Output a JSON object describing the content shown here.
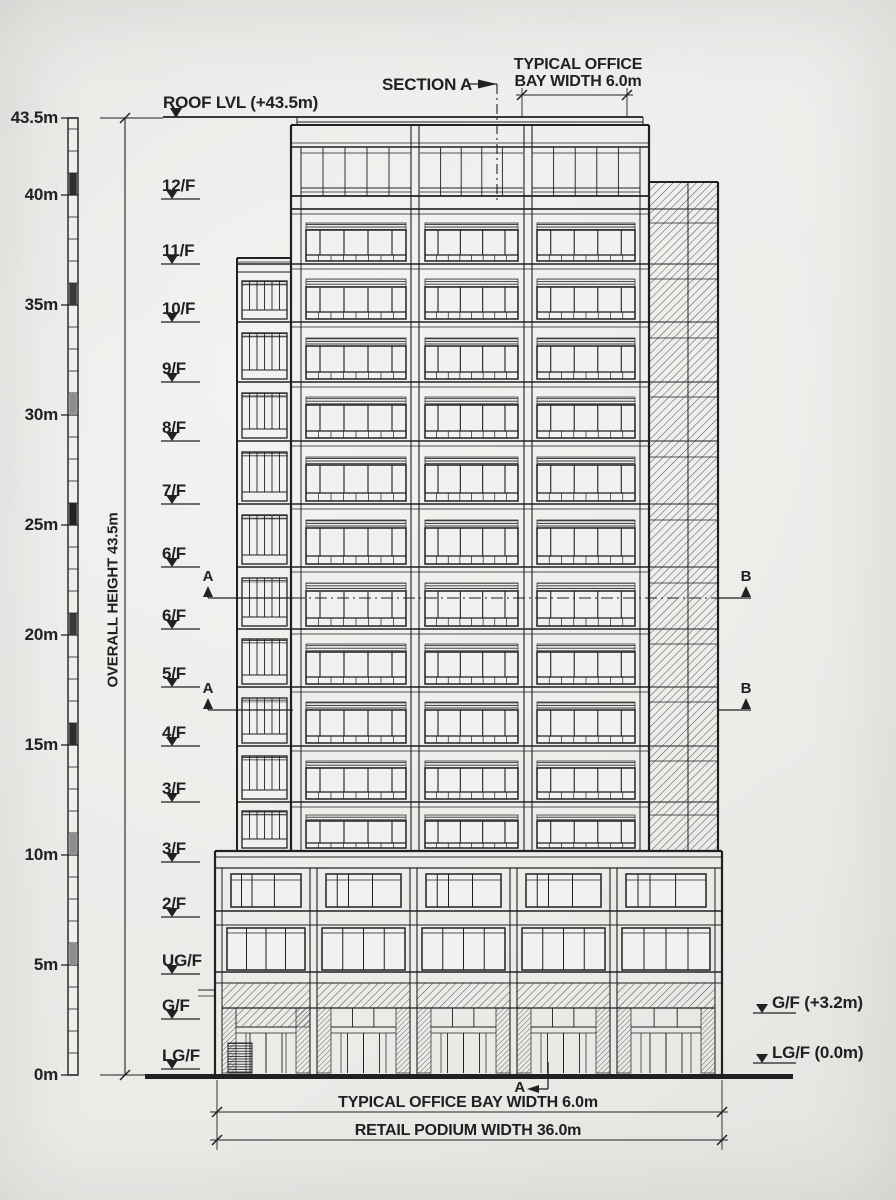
{
  "sheet": {
    "paper_color": "#ECEBE8",
    "ink_color": "#212123"
  },
  "scale_bar": {
    "unit": "m",
    "max": "43.5m",
    "labels": [
      {
        "text": "43.5m",
        "m": 43.5
      },
      {
        "text": "40m",
        "m": 40
      },
      {
        "text": "35m",
        "m": 35
      },
      {
        "text": "30m",
        "m": 30
      },
      {
        "text": "25m",
        "m": 25
      },
      {
        "text": "20m",
        "m": 20
      },
      {
        "text": "15m",
        "m": 15
      },
      {
        "text": "10m",
        "m": 10
      },
      {
        "text": "5m",
        "m": 5
      },
      {
        "text": "0m",
        "m": 0
      }
    ]
  },
  "overall_height": {
    "label": "OVERALL HEIGHT 43.5m"
  },
  "roof_marker": {
    "label": "ROOF LVL (+43.5m)",
    "y": 117
  },
  "floor_markers": [
    {
      "label": "12/F",
      "y": 199
    },
    {
      "label": "11/F",
      "y": 264
    },
    {
      "label": "10/F",
      "y": 322
    },
    {
      "label": "9/F",
      "y": 382
    },
    {
      "label": "8/F",
      "y": 441
    },
    {
      "label": "7/F",
      "y": 504
    },
    {
      "label": "6/F",
      "y": 567
    },
    {
      "label": "6/F",
      "y": 629
    },
    {
      "label": "5/F",
      "y": 687
    },
    {
      "label": "4/F",
      "y": 746
    },
    {
      "label": "3/F",
      "y": 802
    },
    {
      "label": "3/F",
      "y": 862
    },
    {
      "label": "2/F",
      "y": 917
    },
    {
      "label": "UG/F",
      "y": 974
    },
    {
      "label": "G/F",
      "y": 1019
    },
    {
      "label": "LG/F",
      "y": 1069
    }
  ],
  "right_markers": [
    {
      "label": "G/F (+3.2m)",
      "y": 1013
    },
    {
      "label": "LG/F (0.0m)",
      "y": 1063
    }
  ],
  "section_markers": {
    "top": {
      "label": "SECTION A"
    },
    "bottom": {
      "label": "A"
    },
    "left": [
      {
        "label": "A",
        "y": 598
      },
      {
        "label": "A",
        "y": 710
      }
    ],
    "right": [
      {
        "label": "B",
        "y": 598
      },
      {
        "label": "B",
        "y": 710
      }
    ]
  },
  "dimensions": {
    "top": {
      "line1": "TYPICAL OFFICE",
      "line2": "BAY WIDTH 6.0m"
    },
    "bottom": [
      {
        "label": "TYPICAL OFFICE BAY WIDTH 6.0m",
        "y": 1112
      },
      {
        "label": "RETAIL PODIUM WIDTH 36.0m",
        "y": 1140
      }
    ]
  }
}
